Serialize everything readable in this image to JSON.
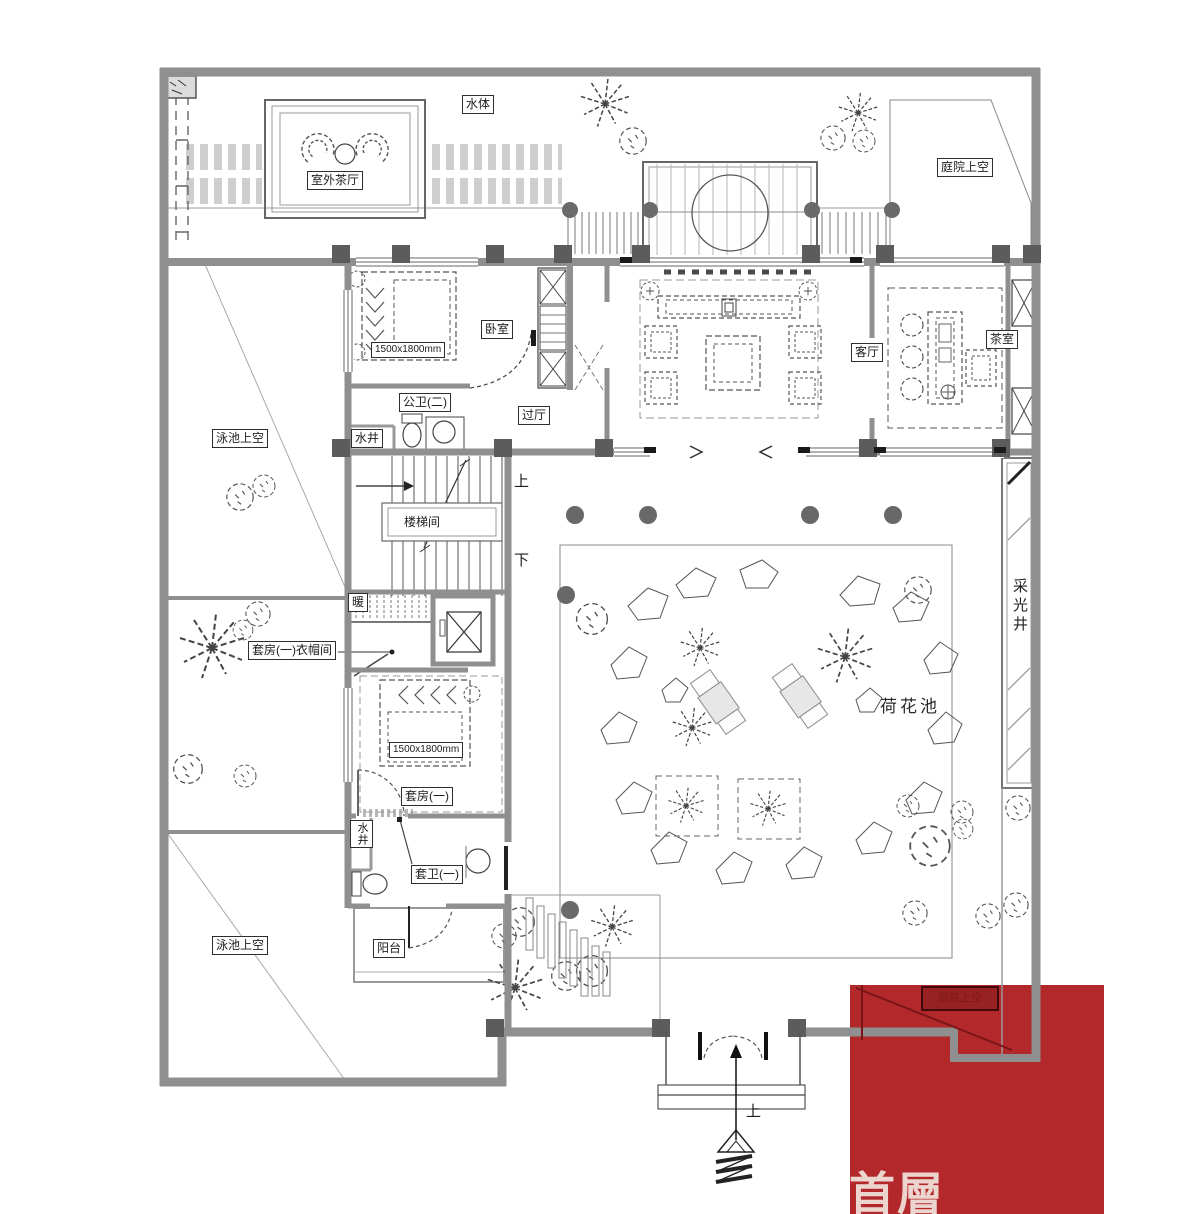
{
  "plan": {
    "floor_tag": "首層",
    "labels": {
      "water_body": "水体",
      "outdoor_tea_hall": "室外茶厅",
      "courtyard_void": "庭院上空",
      "bedroom": "卧室",
      "passage_hall": "过厅",
      "public_bath_2": "公卫(二)",
      "water_well_upper": "水井",
      "living_hall": "客厅",
      "tea_room": "茶室",
      "pool_void_upper": "泳池上空",
      "stair_room": "楼梯间",
      "stair_up": "上",
      "stair_down": "下",
      "heating": "暖",
      "suite_1_cloakroom": "套房(一)衣帽间",
      "bed_size_main": "1500x1800mm",
      "bed_size_suite": "1500x1800mm",
      "suite_1": "套房(一)",
      "suite_bath_1": "套卫(一)",
      "water_well_lower": "水井",
      "balcony": "阳台",
      "pool_void_lower": "泳池上空",
      "lotus_pond": "荷花池",
      "light_well": "采光井",
      "entry_up": "上",
      "red_area": "庭院上空"
    },
    "colors": {
      "wall_gray": "#8f8f8f",
      "column_gray": "#5c5c5c",
      "line_dark": "#3c3c3c",
      "highlight_red": "#b2282b",
      "floor_tag_text": "#ecd4cf"
    }
  }
}
